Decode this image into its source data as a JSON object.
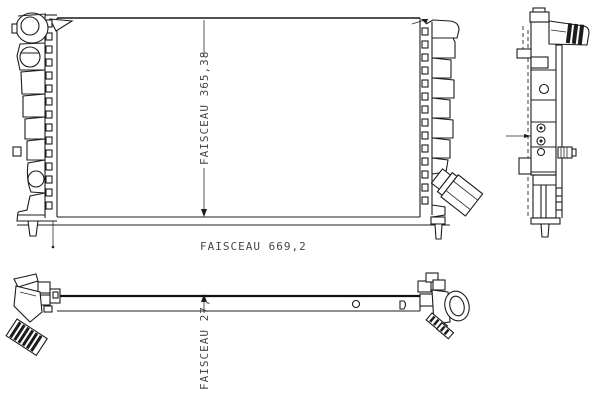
{
  "diagram": {
    "colors": {
      "background": "#ffffff",
      "line": "#1c1c1c",
      "dimension_text": "#474747"
    }
  },
  "dimensions": {
    "core_height_label": "FAISCEAU  365,38",
    "core_width_label": "FAISCEAU  669,2",
    "core_depth_label": "FAISCEAU  27,"
  }
}
